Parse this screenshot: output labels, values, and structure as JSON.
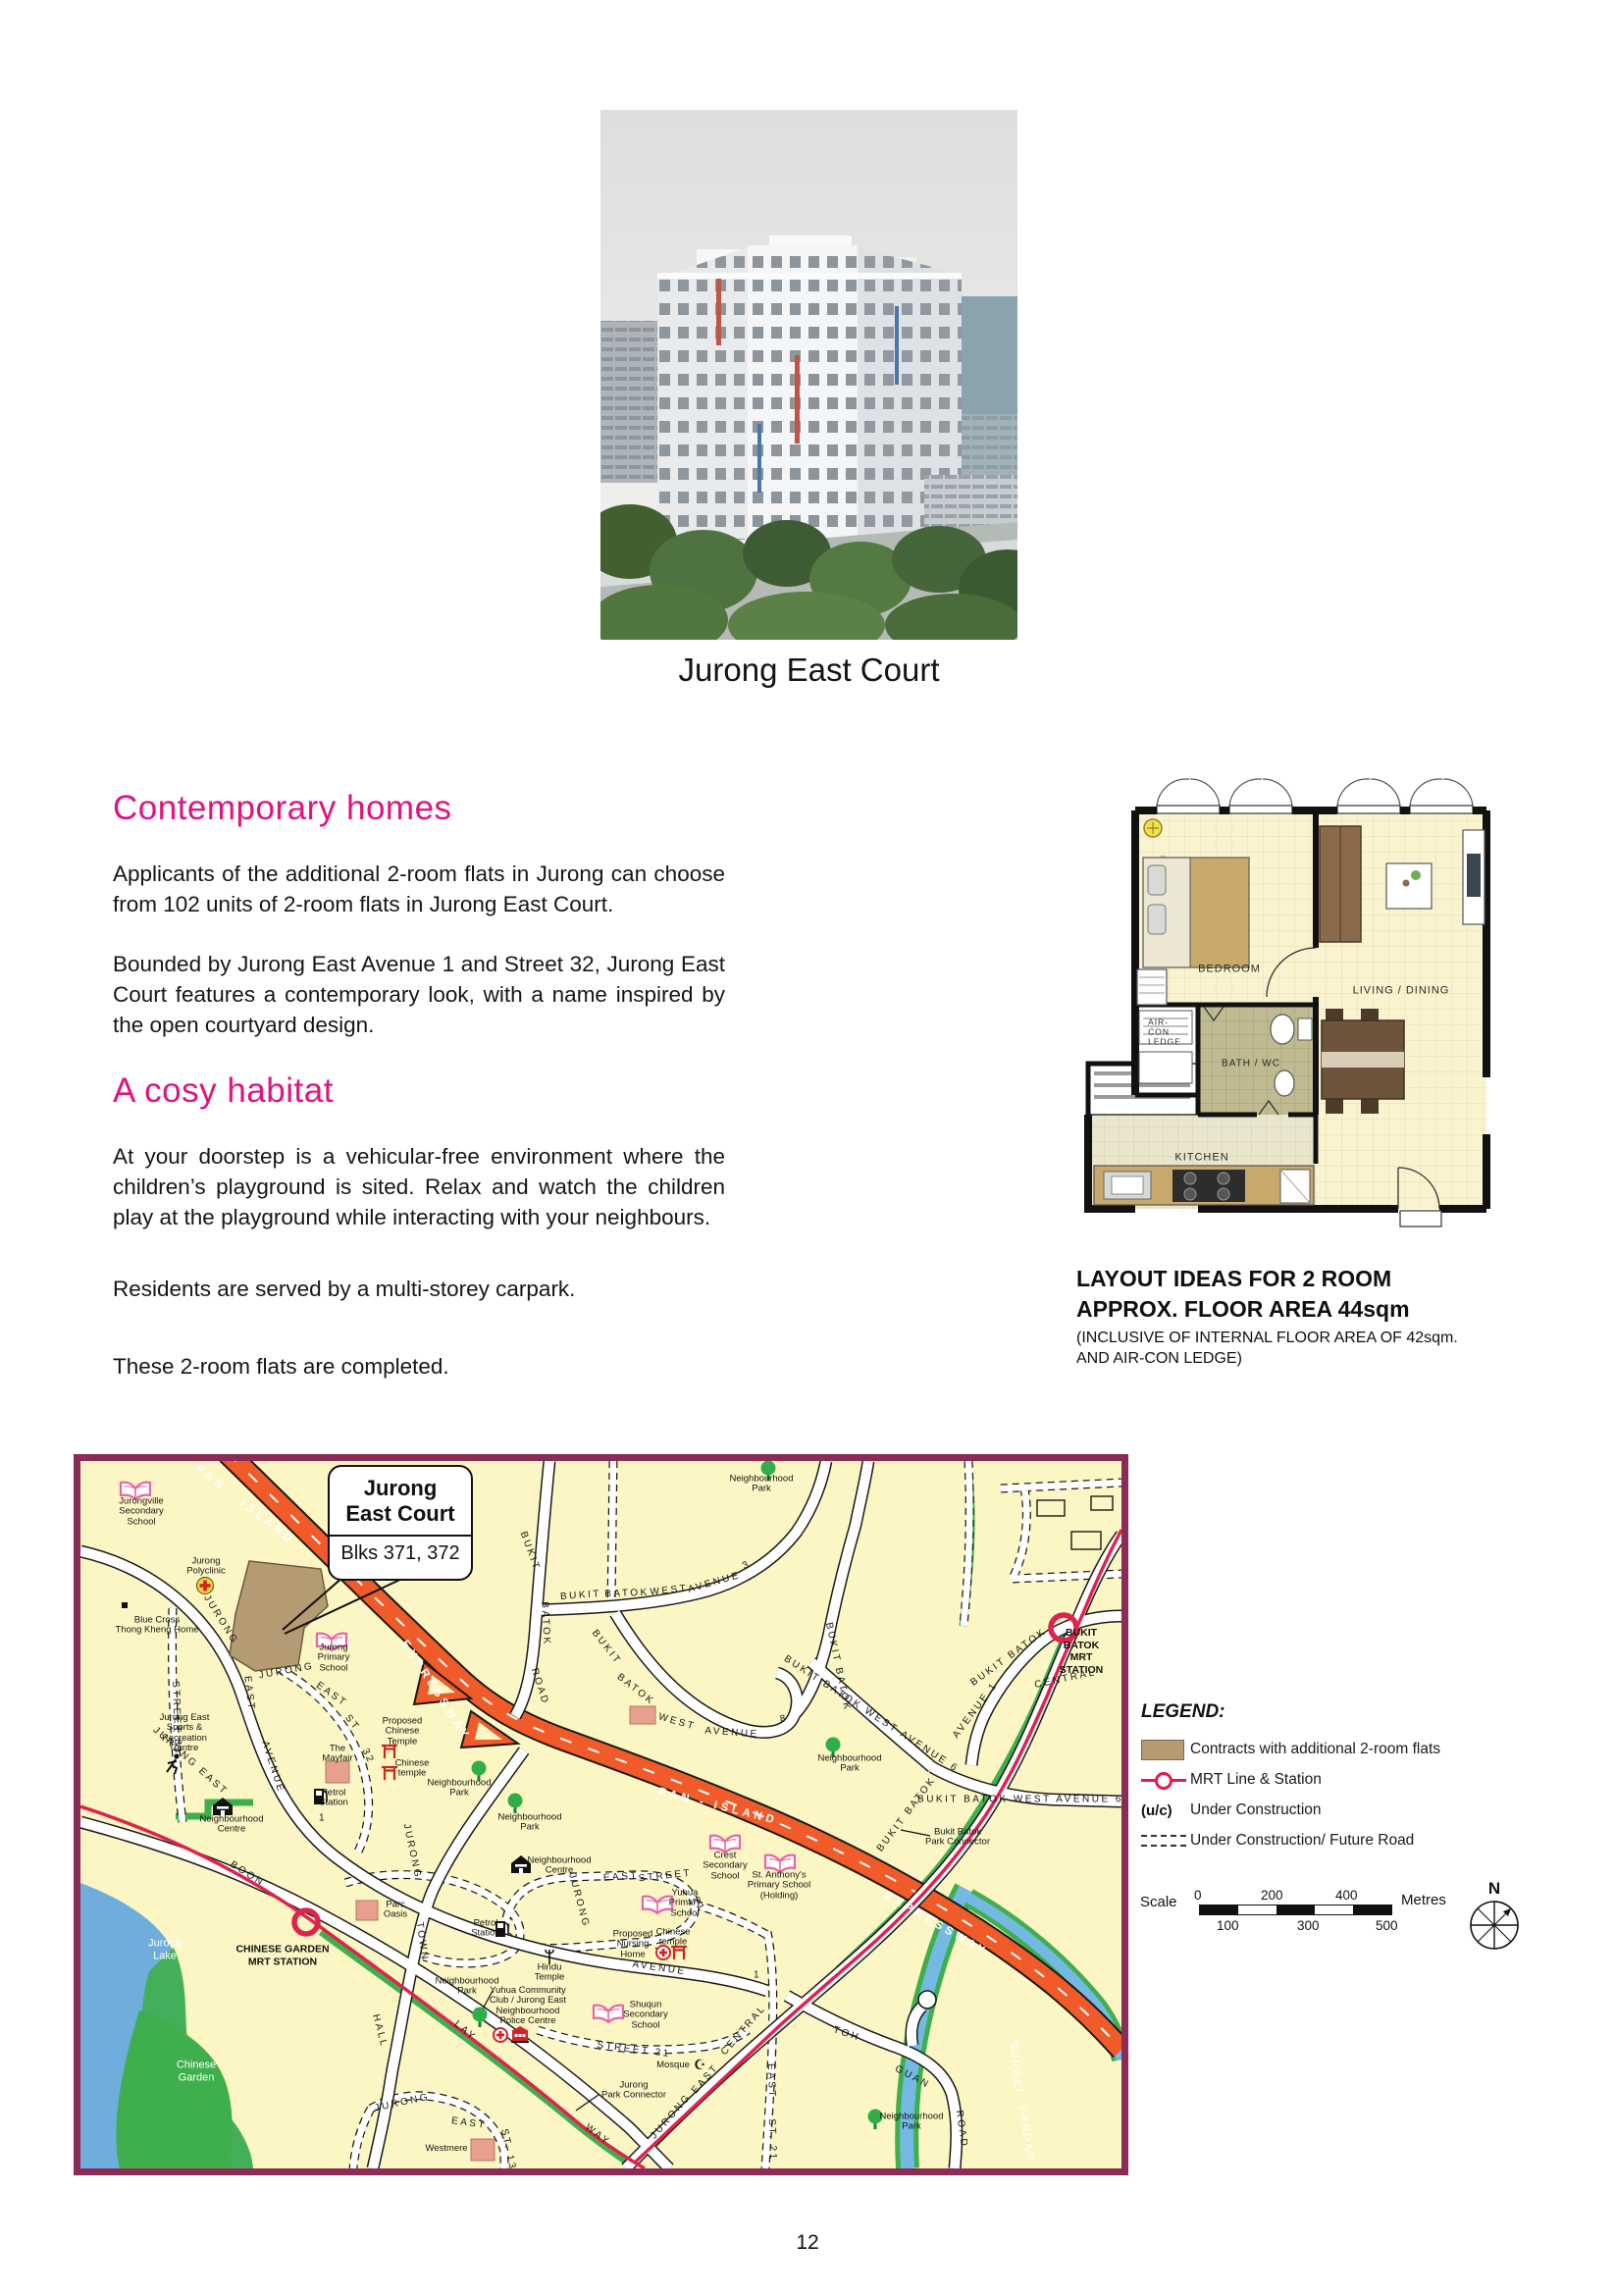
{
  "page": {
    "number": "12"
  },
  "photo": {
    "caption": "Jurong East Court"
  },
  "sections": {
    "heading1": "Contemporary homes",
    "para1": "Applicants of the additional 2-room flats in Jurong can choose from 102 units of 2-room flats in Jurong East Court.",
    "para2": "Bounded by Jurong East Avenue 1 and Street 32, Jurong East Court features a contemporary look, with a name inspired by the open courtyard design.",
    "heading2": "A cosy habitat",
    "para3": "At your doorstep is a vehicular-free environment where the children’s playground is sited. Relax and watch the children play at the playground while interacting with your neighbours.",
    "para4": "Residents are served by a multi-storey carpark.",
    "para5": "These 2-room flats are completed."
  },
  "floorplan": {
    "rooms": {
      "bedroom": "BEDROOM",
      "living": "LIVING / DINING",
      "bath": "BATH / WC",
      "kitchen": "KITCHEN",
      "aircon": "AIR-\nCON\nLEDGE"
    },
    "caption_line1": "LAYOUT IDEAS FOR 2 ROOM",
    "caption_line2": "APPROX. FLOOR AREA 44sqm",
    "caption_line3": "(INCLUSIVE OF INTERNAL FLOOR AREA OF 42sqm.",
    "caption_line4": "AND AIR-CON LEDGE)"
  },
  "map": {
    "callout": {
      "title": "Jurong\nEast Court",
      "subtitle": "Blks 371, 372"
    },
    "labels": [
      {
        "t": "PAN - ISLAND"
      },
      {
        "t": "EXPRESSWAY"
      },
      {
        "t": "PAN - ISLAND"
      },
      {
        "t": "EXPRESSWAY"
      },
      {
        "t": "JURONG"
      },
      {
        "t": "EAST"
      },
      {
        "t": "AVENUE"
      },
      {
        "t": "1"
      },
      {
        "t": "JURONG"
      },
      {
        "t": "EAST"
      },
      {
        "t": "ST"
      },
      {
        "t": "32"
      },
      {
        "t": "JURONG EAST"
      },
      {
        "t": "STREET 31"
      },
      {
        "t": "BOON"
      },
      {
        "t": "LAY"
      },
      {
        "t": "WAY"
      },
      {
        "t": "JURONG"
      },
      {
        "t": "TOWN"
      },
      {
        "t": "HALL"
      },
      {
        "t": "BUKIT"
      },
      {
        "t": "BATOK"
      },
      {
        "t": "ROAD"
      },
      {
        "t": "BUKIT"
      },
      {
        "t": "BATOK"
      },
      {
        "t": "WEST"
      },
      {
        "t": "AVENUE"
      },
      {
        "t": "3"
      },
      {
        "t": "BUKIT"
      },
      {
        "t": "BATOK"
      },
      {
        "t": "WEST"
      },
      {
        "t": "AVENUE"
      },
      {
        "t": "8"
      },
      {
        "t": "BUKIT BATOK"
      },
      {
        "t": "BUKIT BATOK WEST AVENUE 6"
      },
      {
        "t": "BUKIT BATOK WEST AVENUE 6"
      },
      {
        "t": "BUKIT BATOK"
      },
      {
        "t": "AVENUE 1"
      },
      {
        "t": "BUKIT BATOK"
      },
      {
        "t": "CENTRAL"
      },
      {
        "t": "JURONG"
      },
      {
        "t": "EAST"
      },
      {
        "t": "STREET"
      },
      {
        "t": "21"
      },
      {
        "t": "STREET 21"
      },
      {
        "t": "JURONG"
      },
      {
        "t": "EAST"
      },
      {
        "t": "CENTRAL"
      },
      {
        "t": "EAST"
      },
      {
        "t": "ST. 21"
      },
      {
        "t": "JURONG"
      },
      {
        "t": "EAST"
      },
      {
        "t": "ST. 13"
      },
      {
        "t": "TOH"
      },
      {
        "t": "GUAN"
      },
      {
        "t": "ROAD"
      },
      {
        "t": "AVENUE"
      },
      {
        "t": "1"
      },
      {
        "t": "Jurong\nLake"
      },
      {
        "t": "Chinese\nGarden"
      },
      {
        "t": "SUNGEI"
      },
      {
        "t": "PANDAN"
      },
      {
        "t": "CHINESE GARDEN\nMRT STATION"
      },
      {
        "t": "BUKIT BATOK\nMRT STATION"
      },
      {
        "t": "Jurongville\nSecondary\nSchool"
      },
      {
        "t": "Jurong\nPolyclinic"
      },
      {
        "t": "Blue Cross\nThong Kheng Home"
      },
      {
        "t": "Jurong\nPrimary\nSchool"
      },
      {
        "t": "Jurong East\nSports &\nRecreation\nCentre"
      },
      {
        "t": "Proposed\nChinese\nTemple"
      },
      {
        "t": "Chinese\ntemple"
      },
      {
        "t": "The\nMayfair"
      },
      {
        "t": "Petrol\nStation"
      },
      {
        "t": "Neighbourhood\nCentre"
      },
      {
        "t": "Neighbourhood\nPark"
      },
      {
        "t": "Neighbourhood\nPark"
      },
      {
        "t": "Neighbourhood\nPark"
      },
      {
        "t": "Neighbourhood\nCentre"
      },
      {
        "t": "Petrol\nStation"
      },
      {
        "t": "Parc\nOasis"
      },
      {
        "t": "Crest\nSecondary\nSchool"
      },
      {
        "t": "St. Anthony's\nPrimary School\n(Holding)"
      },
      {
        "t": "Yuhua\nPrimary\nSchool"
      },
      {
        "t": "Hindu\nTemple"
      },
      {
        "t": "Proposed\nNursing\nHome"
      },
      {
        "t": "Chinese\ntemple"
      },
      {
        "t": "Yuhua Community\nClub / Jurong East\nNeighbourhood\nPolice Centre"
      },
      {
        "t": "Neighbourhood\nPark"
      },
      {
        "t": "Shuqun\nSecondary\nSchool"
      },
      {
        "t": "Mosque"
      },
      {
        "t": "Jurong\nPark Connector"
      },
      {
        "t": "Westmere"
      },
      {
        "t": "Neighbourhood\nPark"
      },
      {
        "t": "Bukit Batok\nPark Connector"
      },
      {
        "t": "Neighbourhood\nPark"
      }
    ],
    "legend": {
      "title": "LEGEND:",
      "items": [
        {
          "label": "Contracts with additional 2-room flats"
        },
        {
          "label": "MRT Line & Station"
        },
        {
          "prefix": "(u/c)",
          "label": "Under Construction"
        },
        {
          "label": "Under Construction/ Future Road"
        }
      ],
      "scale": {
        "label": "Scale",
        "t0": "0",
        "t200": "200",
        "t400": "400",
        "b100": "100",
        "b300": "300",
        "b500": "500",
        "unit": "Metres"
      },
      "compass_n": "N"
    }
  },
  "colors": {
    "heading_pink": "#e2127e",
    "map_border": "#8b2b56",
    "expressway_orange": "#f15a29",
    "mrt_red": "#e0224c",
    "site_tan": "#b59b72",
    "lake_blue": "#6faedc",
    "park_green": "#3faf4d",
    "map_bg": "#fbf6c3"
  }
}
